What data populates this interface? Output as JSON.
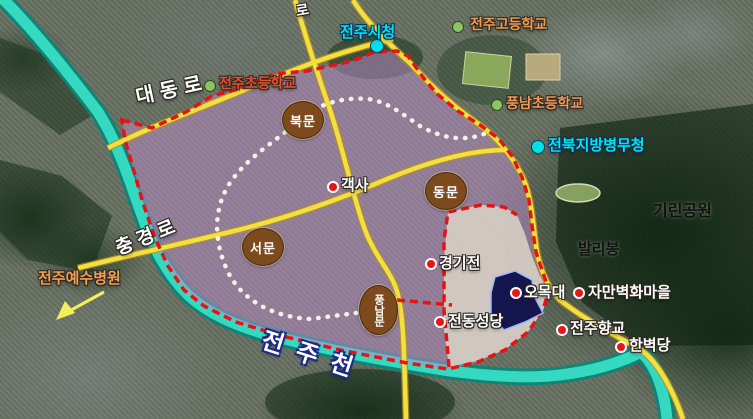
{
  "colors": {
    "river": "#2fd6be",
    "road_yellow": "#f2e042",
    "boundary_red": "#e41414",
    "overlay_purple": "#b98cc6",
    "hanok_area": "#dbd7cb",
    "gate_circle_brown": "#7c4a1d",
    "label_cyan": "#00e4ea",
    "label_school_orange": "#f09a55",
    "label_school_red_orange": "#e8502c",
    "poi_label_white": "#ffffff",
    "terrain_label_black": "#101010",
    "marker_red": "#e81616",
    "marker_green": "#8cc464",
    "omokdae_site_navy": "#16164e"
  },
  "gates": [
    {
      "label": "북문"
    },
    {
      "label": "동문"
    },
    {
      "label": "서문"
    },
    {
      "label": "풍남문"
    }
  ],
  "historic_sites": [
    {
      "label": "객사"
    },
    {
      "label": "경기전"
    },
    {
      "label": "오목대"
    },
    {
      "label": "자만벽화마을"
    },
    {
      "label": "전동성당"
    },
    {
      "label": "전주향교"
    },
    {
      "label": "한벽당"
    }
  ],
  "public_buildings": [
    {
      "label": "전주시청"
    },
    {
      "label": "전북지방병무청"
    }
  ],
  "schools": [
    {
      "label": "전주초등학교"
    },
    {
      "label": "전주고등학교"
    },
    {
      "label": "풍남초등학교"
    }
  ],
  "hospital": {
    "label": "전주예수병원"
  },
  "nature": [
    {
      "label": "기린공원"
    },
    {
      "label": "발리봉"
    }
  ],
  "road_names": [
    {
      "label": "대동로"
    },
    {
      "label": "충경로"
    },
    {
      "label": "로"
    }
  ],
  "river_name": {
    "label": "전주천"
  }
}
